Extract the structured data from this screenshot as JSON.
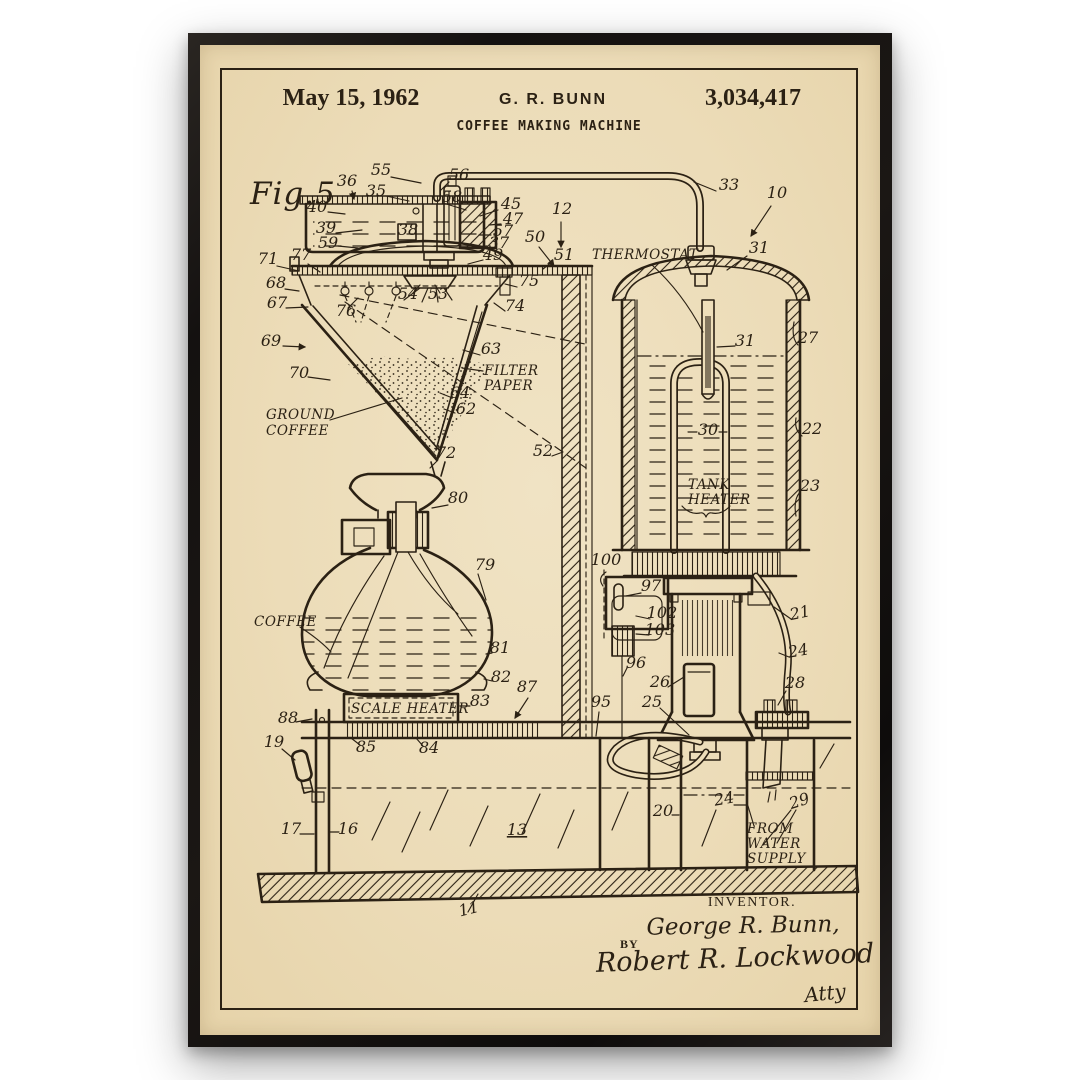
{
  "colors": {
    "paper": "#ecdcb8",
    "ink": "#2b2114",
    "frame": "#141110",
    "background": "#ffffff"
  },
  "header": {
    "date": "May 15, 1962",
    "inventor": "G. R. BUNN",
    "patent_number": "3,034,417",
    "title": "COFFEE MAKING MACHINE"
  },
  "signature": {
    "inventor_heading": "INVENTOR.",
    "inventor_name": "George R. Bunn,",
    "by_label": "BY",
    "attorney_signature": "Robert R. Lockwood",
    "attorney_mark": "Atty"
  },
  "diagram": {
    "figure_label": "Fig.5",
    "annotations": [
      {
        "id": "figure",
        "lines": [
          "Fig.5"
        ],
        "x": 250,
        "y": 204,
        "cls": "fig"
      },
      {
        "id": "thermostat",
        "lines": [
          "THERMOSTAT"
        ],
        "x": 592,
        "y": 259
      },
      {
        "id": "filter-paper",
        "lines": [
          "FILTER",
          "PAPER"
        ],
        "x": 484,
        "y": 375,
        "lh": 15
      },
      {
        "id": "ground-coffee",
        "lines": [
          "GROUND",
          "COFFEE"
        ],
        "x": 266,
        "y": 419,
        "lh": 16
      },
      {
        "id": "tank-heater",
        "lines": [
          "TANK",
          "HEATER"
        ],
        "x": 688,
        "y": 489,
        "lh": 15
      },
      {
        "id": "coffee",
        "lines": [
          "COFFEE"
        ],
        "x": 254,
        "y": 626
      },
      {
        "id": "scale-heater",
        "lines": [
          "SCALE HEATER"
        ],
        "x": 351,
        "y": 713
      },
      {
        "id": "from-water-supply",
        "lines": [
          "FROM",
          "WATER",
          "SUPPLY"
        ],
        "x": 747,
        "y": 833,
        "lh": 15
      }
    ],
    "part_numbers": [
      {
        "t": "36",
        "x": 347,
        "y": 186
      },
      {
        "t": "55",
        "x": 381,
        "y": 175
      },
      {
        "t": "35",
        "x": 376,
        "y": 196
      },
      {
        "t": "56",
        "x": 459,
        "y": 180
      },
      {
        "t": "58",
        "x": 452,
        "y": 202
      },
      {
        "t": "40",
        "x": 317,
        "y": 212
      },
      {
        "t": "39",
        "x": 326,
        "y": 233
      },
      {
        "t": "59",
        "x": 328,
        "y": 248
      },
      {
        "t": "38",
        "x": 408,
        "y": 235
      },
      {
        "t": "45",
        "x": 511,
        "y": 209
      },
      {
        "t": "47",
        "x": 513,
        "y": 224
      },
      {
        "t": "57",
        "x": 503,
        "y": 236
      },
      {
        "t": "37",
        "x": 499,
        "y": 248
      },
      {
        "t": "12",
        "x": 562,
        "y": 214
      },
      {
        "t": "50",
        "x": 535,
        "y": 242
      },
      {
        "t": "51",
        "x": 564,
        "y": 260
      },
      {
        "t": "49",
        "x": 493,
        "y": 260
      },
      {
        "t": "33",
        "x": 729,
        "y": 190
      },
      {
        "t": "10",
        "x": 777,
        "y": 198
      },
      {
        "t": "31",
        "x": 759,
        "y": 253
      },
      {
        "t": "71",
        "x": 268,
        "y": 264
      },
      {
        "t": "77",
        "x": 301,
        "y": 260
      },
      {
        "t": "75",
        "x": 529,
        "y": 286
      },
      {
        "t": "74",
        "x": 515,
        "y": 311
      },
      {
        "t": "68",
        "x": 276,
        "y": 288
      },
      {
        "t": "54",
        "x": 408,
        "y": 299
      },
      {
        "t": "53",
        "x": 438,
        "y": 299
      },
      {
        "t": "67",
        "x": 277,
        "y": 308
      },
      {
        "t": "76",
        "x": 346,
        "y": 316
      },
      {
        "t": "69",
        "x": 271,
        "y": 346
      },
      {
        "t": "63",
        "x": 491,
        "y": 354
      },
      {
        "t": "70",
        "x": 299,
        "y": 378
      },
      {
        "t": "64",
        "x": 460,
        "y": 398
      },
      {
        "t": "62",
        "x": 466,
        "y": 414
      },
      {
        "t": "27",
        "x": 808,
        "y": 343
      },
      {
        "t": "31",
        "x": 745,
        "y": 346
      },
      {
        "t": "22",
        "x": 812,
        "y": 434
      },
      {
        "t": "30",
        "x": 708,
        "y": 435
      },
      {
        "t": "23",
        "x": 810,
        "y": 491
      },
      {
        "t": "52",
        "x": 543,
        "y": 456
      },
      {
        "t": "72",
        "x": 446,
        "y": 458
      },
      {
        "t": "80",
        "x": 458,
        "y": 503
      },
      {
        "t": "100",
        "x": 606,
        "y": 565
      },
      {
        "t": "79",
        "x": 485,
        "y": 570
      },
      {
        "t": "97",
        "x": 651,
        "y": 591
      },
      {
        "t": "21",
        "x": 801,
        "y": 618,
        "r": -12
      },
      {
        "t": "102",
        "x": 662,
        "y": 618
      },
      {
        "t": "103",
        "x": 660,
        "y": 635
      },
      {
        "t": "96",
        "x": 636,
        "y": 668
      },
      {
        "t": "24",
        "x": 799,
        "y": 656,
        "r": -10
      },
      {
        "t": "81",
        "x": 500,
        "y": 653
      },
      {
        "t": "26",
        "x": 660,
        "y": 687
      },
      {
        "t": "28",
        "x": 795,
        "y": 688
      },
      {
        "t": "82",
        "x": 501,
        "y": 682
      },
      {
        "t": "25",
        "x": 652,
        "y": 707
      },
      {
        "t": "87",
        "x": 527,
        "y": 692
      },
      {
        "t": "88",
        "x": 288,
        "y": 723
      },
      {
        "t": "95",
        "x": 601,
        "y": 707
      },
      {
        "t": "83",
        "x": 480,
        "y": 706
      },
      {
        "t": "85",
        "x": 366,
        "y": 752
      },
      {
        "t": "84",
        "x": 429,
        "y": 753
      },
      {
        "t": "19",
        "x": 274,
        "y": 747
      },
      {
        "t": "20",
        "x": 663,
        "y": 816
      },
      {
        "t": "24",
        "x": 725,
        "y": 804,
        "r": -10
      },
      {
        "t": "29",
        "x": 801,
        "y": 806,
        "r": -18
      },
      {
        "t": "17",
        "x": 291,
        "y": 834
      },
      {
        "t": "16",
        "x": 348,
        "y": 834
      },
      {
        "t": "13",
        "x": 517,
        "y": 835,
        "u": true
      },
      {
        "t": "11",
        "x": 470,
        "y": 914,
        "r": -14
      }
    ]
  }
}
